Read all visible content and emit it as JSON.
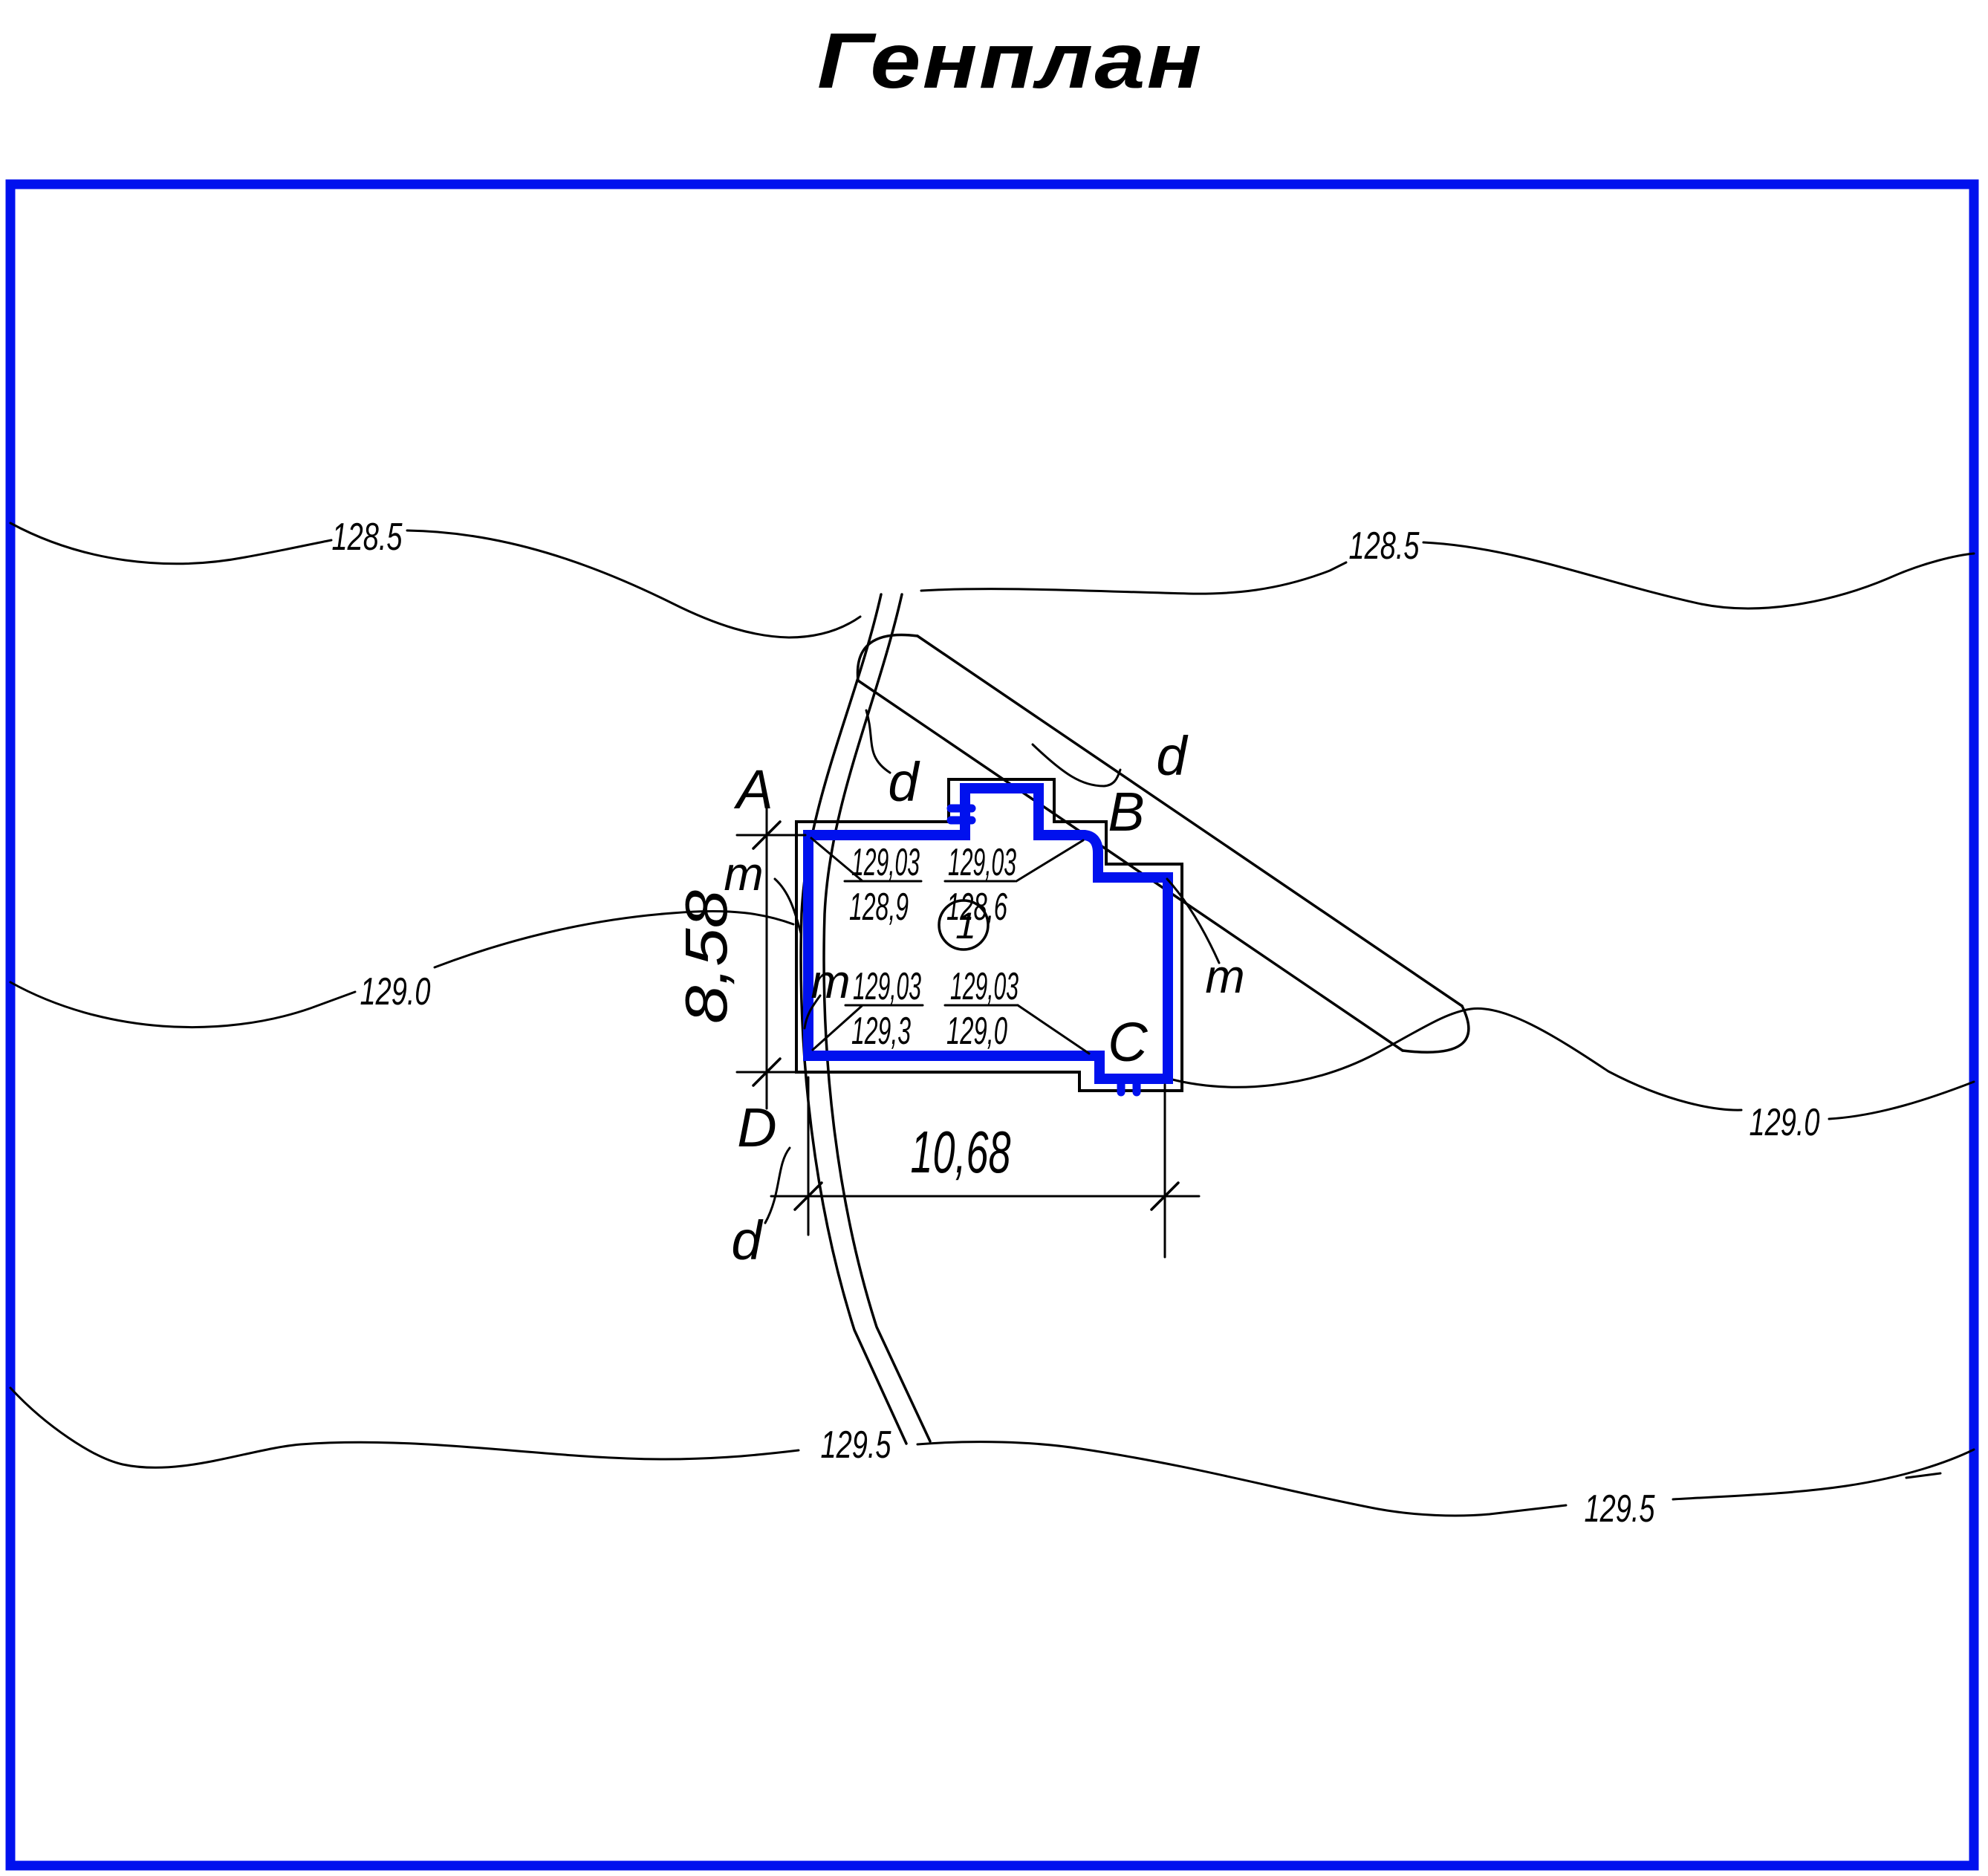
{
  "title": "Генплан",
  "colors": {
    "accent_blue": "#0011ee",
    "ink": "#000000"
  },
  "contours": {
    "c128_5": {
      "label": "128.5"
    },
    "c129_0": {
      "label": "129.0"
    },
    "c129_5": {
      "label": "129.5"
    }
  },
  "site": {
    "walkway_label_top": "d",
    "road_label": "d",
    "walkway_label_bottom": "d",
    "landscape_marks": {
      "m_upper": "m",
      "m_inner": "m",
      "m_right": "m"
    }
  },
  "building": {
    "number": "1",
    "corners": {
      "top_left": "A",
      "top_right": "B",
      "bottom_right": "C",
      "bottom_left": "D"
    },
    "elevations": {
      "top_left": {
        "proposed": "129,03",
        "existing": "128,9"
      },
      "top_right": {
        "proposed": "129,03",
        "existing": "128,6"
      },
      "bottom_left": {
        "proposed": "129,03",
        "existing": "129,3"
      },
      "bottom_right": {
        "proposed": "129,03",
        "existing": "129,0"
      }
    },
    "dimensions": {
      "width_m": "10,68",
      "height_m": "8,58"
    }
  }
}
